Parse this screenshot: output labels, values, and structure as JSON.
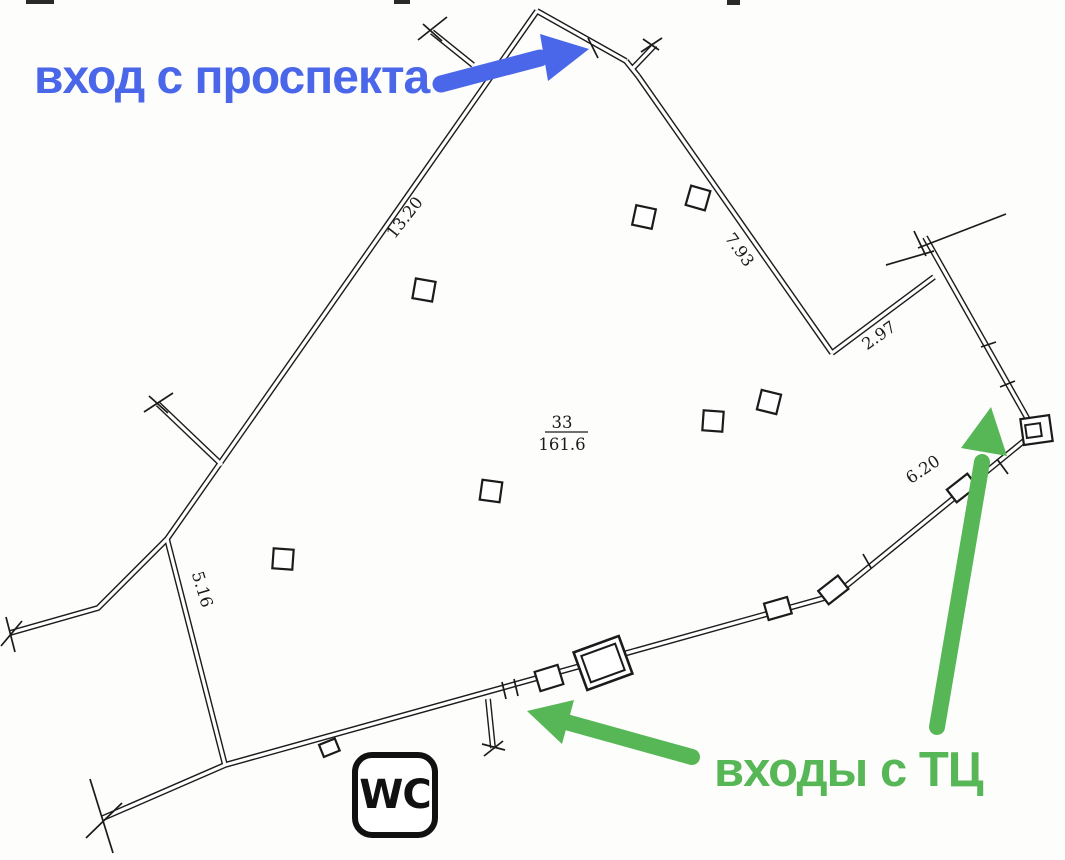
{
  "colors": {
    "ink": "#1b1b1b",
    "paper": "#fdfdfc",
    "arrow_blue": "#4a67ea",
    "arrow_green": "#57b757"
  },
  "annotations": {
    "avenue": {
      "label": "вход с проспекта"
    },
    "mall": {
      "label": "входы с ТЦ"
    }
  },
  "plan": {
    "room": {
      "number": "33",
      "area": "161.6"
    },
    "wc": "WC",
    "dimensions": [
      {
        "value": "13.20"
      },
      {
        "value": "7.93"
      },
      {
        "value": "2.97"
      },
      {
        "value": "6.20"
      },
      {
        "value": "5.16"
      }
    ]
  }
}
